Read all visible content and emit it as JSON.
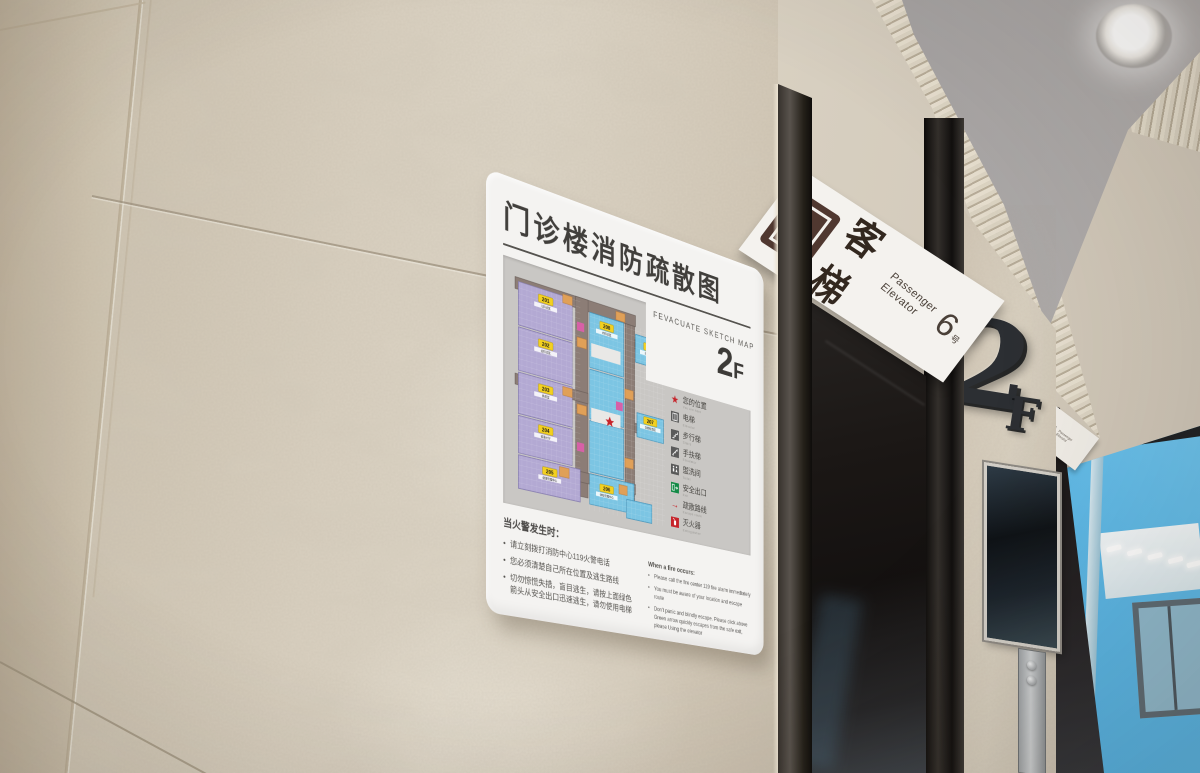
{
  "evacuation_sign": {
    "title": "门诊楼消防疏散图",
    "subtitle": "FEVACUATE SKETCH MAP",
    "floor_number": "2",
    "floor_suffix": "F",
    "map": {
      "rooms": [
        {
          "number": "201",
          "label": "儿科诊区"
        },
        {
          "number": "202",
          "label": "全科诊区"
        },
        {
          "number": "203",
          "label": "换药室"
        },
        {
          "number": "204",
          "label": "输液大厅"
        },
        {
          "number": "205",
          "label": "健康管理中心"
        },
        {
          "number": "206",
          "label": "体检管理中心"
        },
        {
          "number": "207",
          "label": "功能检查区"
        },
        {
          "number": "208",
          "label": "内科诊区"
        },
        {
          "number": "209",
          "label": "妇产科诊区"
        }
      ]
    },
    "legend": [
      {
        "icon": "location-star-icon",
        "label": "您的位置",
        "en": "You are here"
      },
      {
        "icon": "elevator-icon",
        "label": "电梯",
        "en": "Elevator"
      },
      {
        "icon": "stairs-icon",
        "label": "步行梯",
        "en": "Stairs"
      },
      {
        "icon": "escalator-icon",
        "label": "手扶梯",
        "en": "Escalator"
      },
      {
        "icon": "toilet-icon",
        "label": "盥洗间",
        "en": "Toilet"
      },
      {
        "icon": "exit-icon",
        "label": "安全出口",
        "en": "Exit"
      },
      {
        "icon": "route-arrow-icon",
        "label": "疏散路线",
        "en": "Escape route"
      },
      {
        "icon": "extinguisher-icon",
        "label": "灭火器",
        "en": "Extinguisher"
      }
    ],
    "instructions_zh": {
      "heading": "当火警发生时：",
      "items": [
        "请立刻拨打消防中心119火警电话",
        "您必须清楚自己所在位置及逃生路线",
        "切勿惊慌失措，盲目逃生，请按上面绿色箭头从安全出口迅速逃生，请勿使用电梯"
      ]
    },
    "instructions_en": {
      "heading": "When a fire occurs:",
      "items": [
        "Please call the fire center 119 fire alarm immediately",
        "You must be aware of your location and escape route",
        "Don't panic and blindly escape. Please click above Green arrow quickly escapes from the safe exit, please Using the elevator"
      ]
    }
  },
  "elevator_sign": {
    "zh": "客梯",
    "en_line1": "Passenger",
    "en_line2": "Elevator",
    "number": "6",
    "number_unit": "号"
  },
  "far_elevator_sign": {
    "zh": "客梯",
    "en_line1": "Passenger",
    "en_line2": "Elevator"
  },
  "floor_emblem": {
    "number": "2",
    "suffix": "F"
  },
  "colors": {
    "accent_red": "#c6242b",
    "exit_green": "#138a46",
    "sign_brown": "#503830",
    "map_purple": "#b3a9d3",
    "map_blue": "#7cc5e3",
    "map_corridor": "#8c7d76",
    "label_yellow": "#f3d020"
  }
}
